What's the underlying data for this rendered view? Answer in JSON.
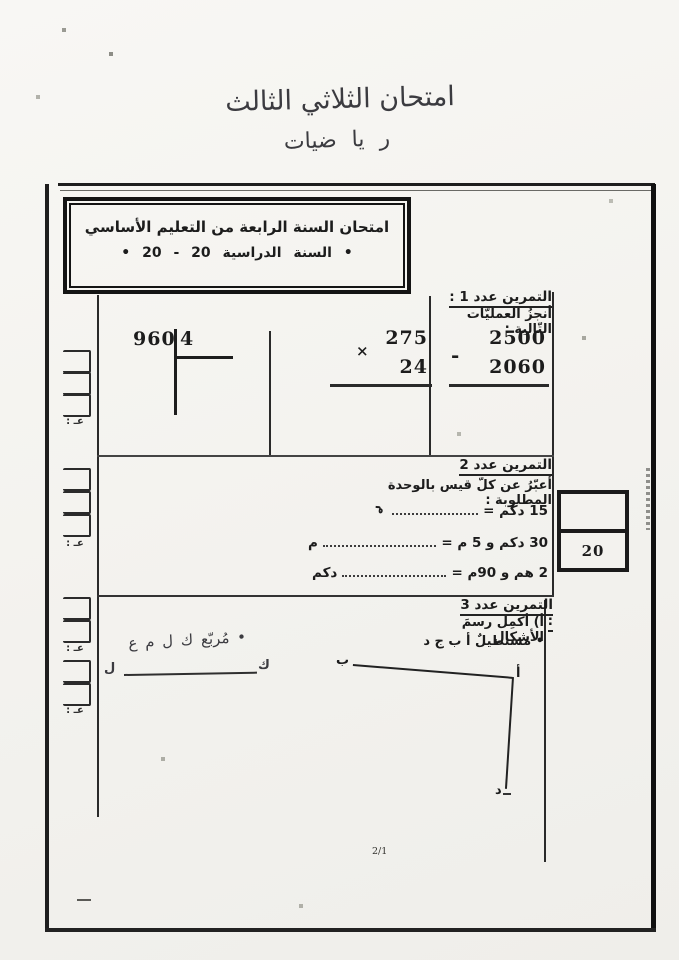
{
  "page": {
    "handwritten_title": "امتحان الثلاثي الثالث",
    "handwritten_subject": "ر يا ضيات",
    "page_number": "2/1"
  },
  "header_box": {
    "line1": "امتحان السنة الرابعة من التعليم الأساسي",
    "line2": "• السنة الدراسية 20 - 20 •"
  },
  "margin": {
    "score_label": "عـ :"
  },
  "exercise1": {
    "title": "التمرين عدد 1 :",
    "instruction": "أنجزُ العمليّات التّالية :",
    "subtraction": {
      "minuend": "2500",
      "operator": "-",
      "subtrahend": "2060"
    },
    "multiplication": {
      "multiplicand": "275",
      "operator": "×",
      "multiplier": "24"
    },
    "division": {
      "dividend": "960",
      "divisor": "4"
    }
  },
  "exercise2": {
    "title": "التمرين عدد 2",
    "instruction": "أعبّرُ عن كلّ قيس بالوحدة المطلوبة :",
    "items": [
      {
        "label": "15 دكم =",
        "unit": "م"
      },
      {
        "label": "30 دكم و 5 م =",
        "unit": "م"
      },
      {
        "label": "2 هم و 90م =",
        "unit": "دكم"
      }
    ],
    "score_value": "20"
  },
  "exercise3": {
    "title": "التمرين عدد 3 :",
    "item_a": "أ) أكمِل رسمَ الأشكال",
    "rectangle_label": "• مستطيلٌ أ ب ج د",
    "square_label": "• مُربّع ك ل م ع",
    "rectangle_points": {
      "top_right": "أ",
      "top_left": "ب",
      "bottom_right": "د"
    },
    "segment_points": {
      "right": "ك",
      "left": "ل"
    }
  }
}
